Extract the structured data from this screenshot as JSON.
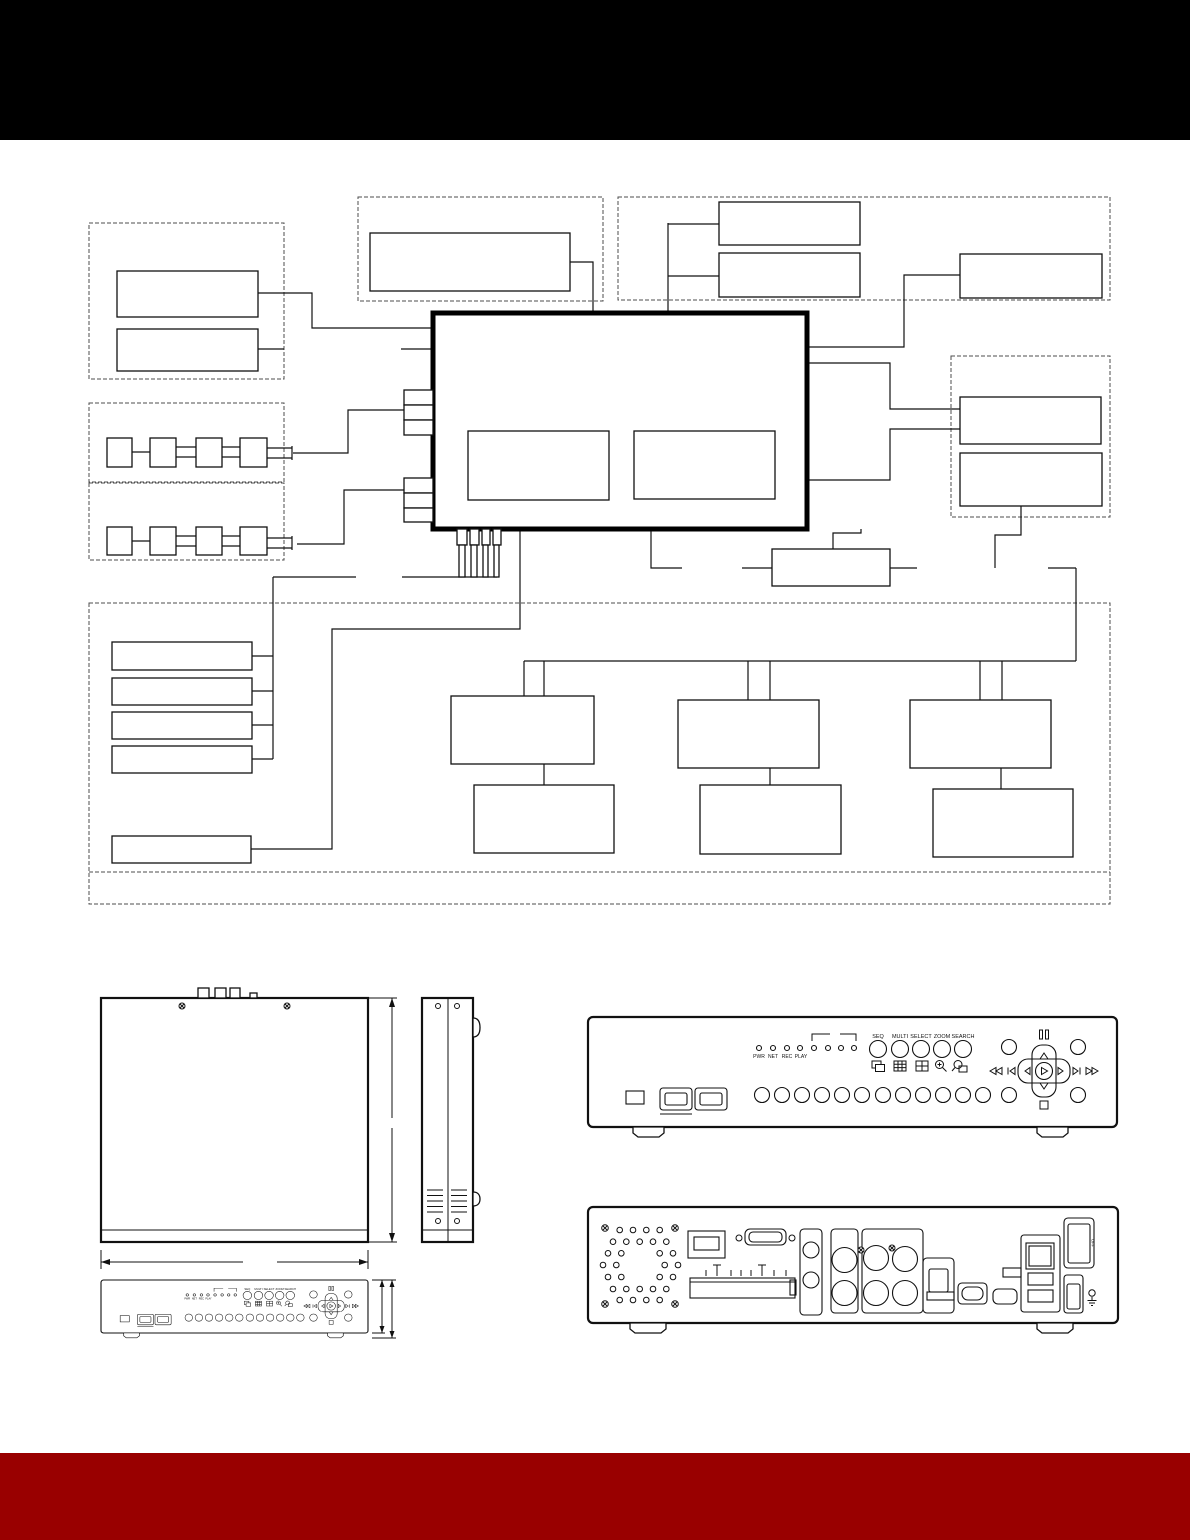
{
  "page": {
    "background": "#ffffff",
    "header_color": "#000000",
    "footer_color": "#990000",
    "line_color": "#111111"
  },
  "front_panel": {
    "led_labels": [
      "PWR",
      "NET",
      "REC",
      "PLAY"
    ],
    "led_count": 8,
    "mode_buttons": [
      "SEQ",
      "MULTI",
      "SELECT",
      "ZOOM",
      "SEARCH"
    ],
    "channel_button_count": 12
  },
  "rear_panel": {
    "power_switch_label": "OFF"
  }
}
